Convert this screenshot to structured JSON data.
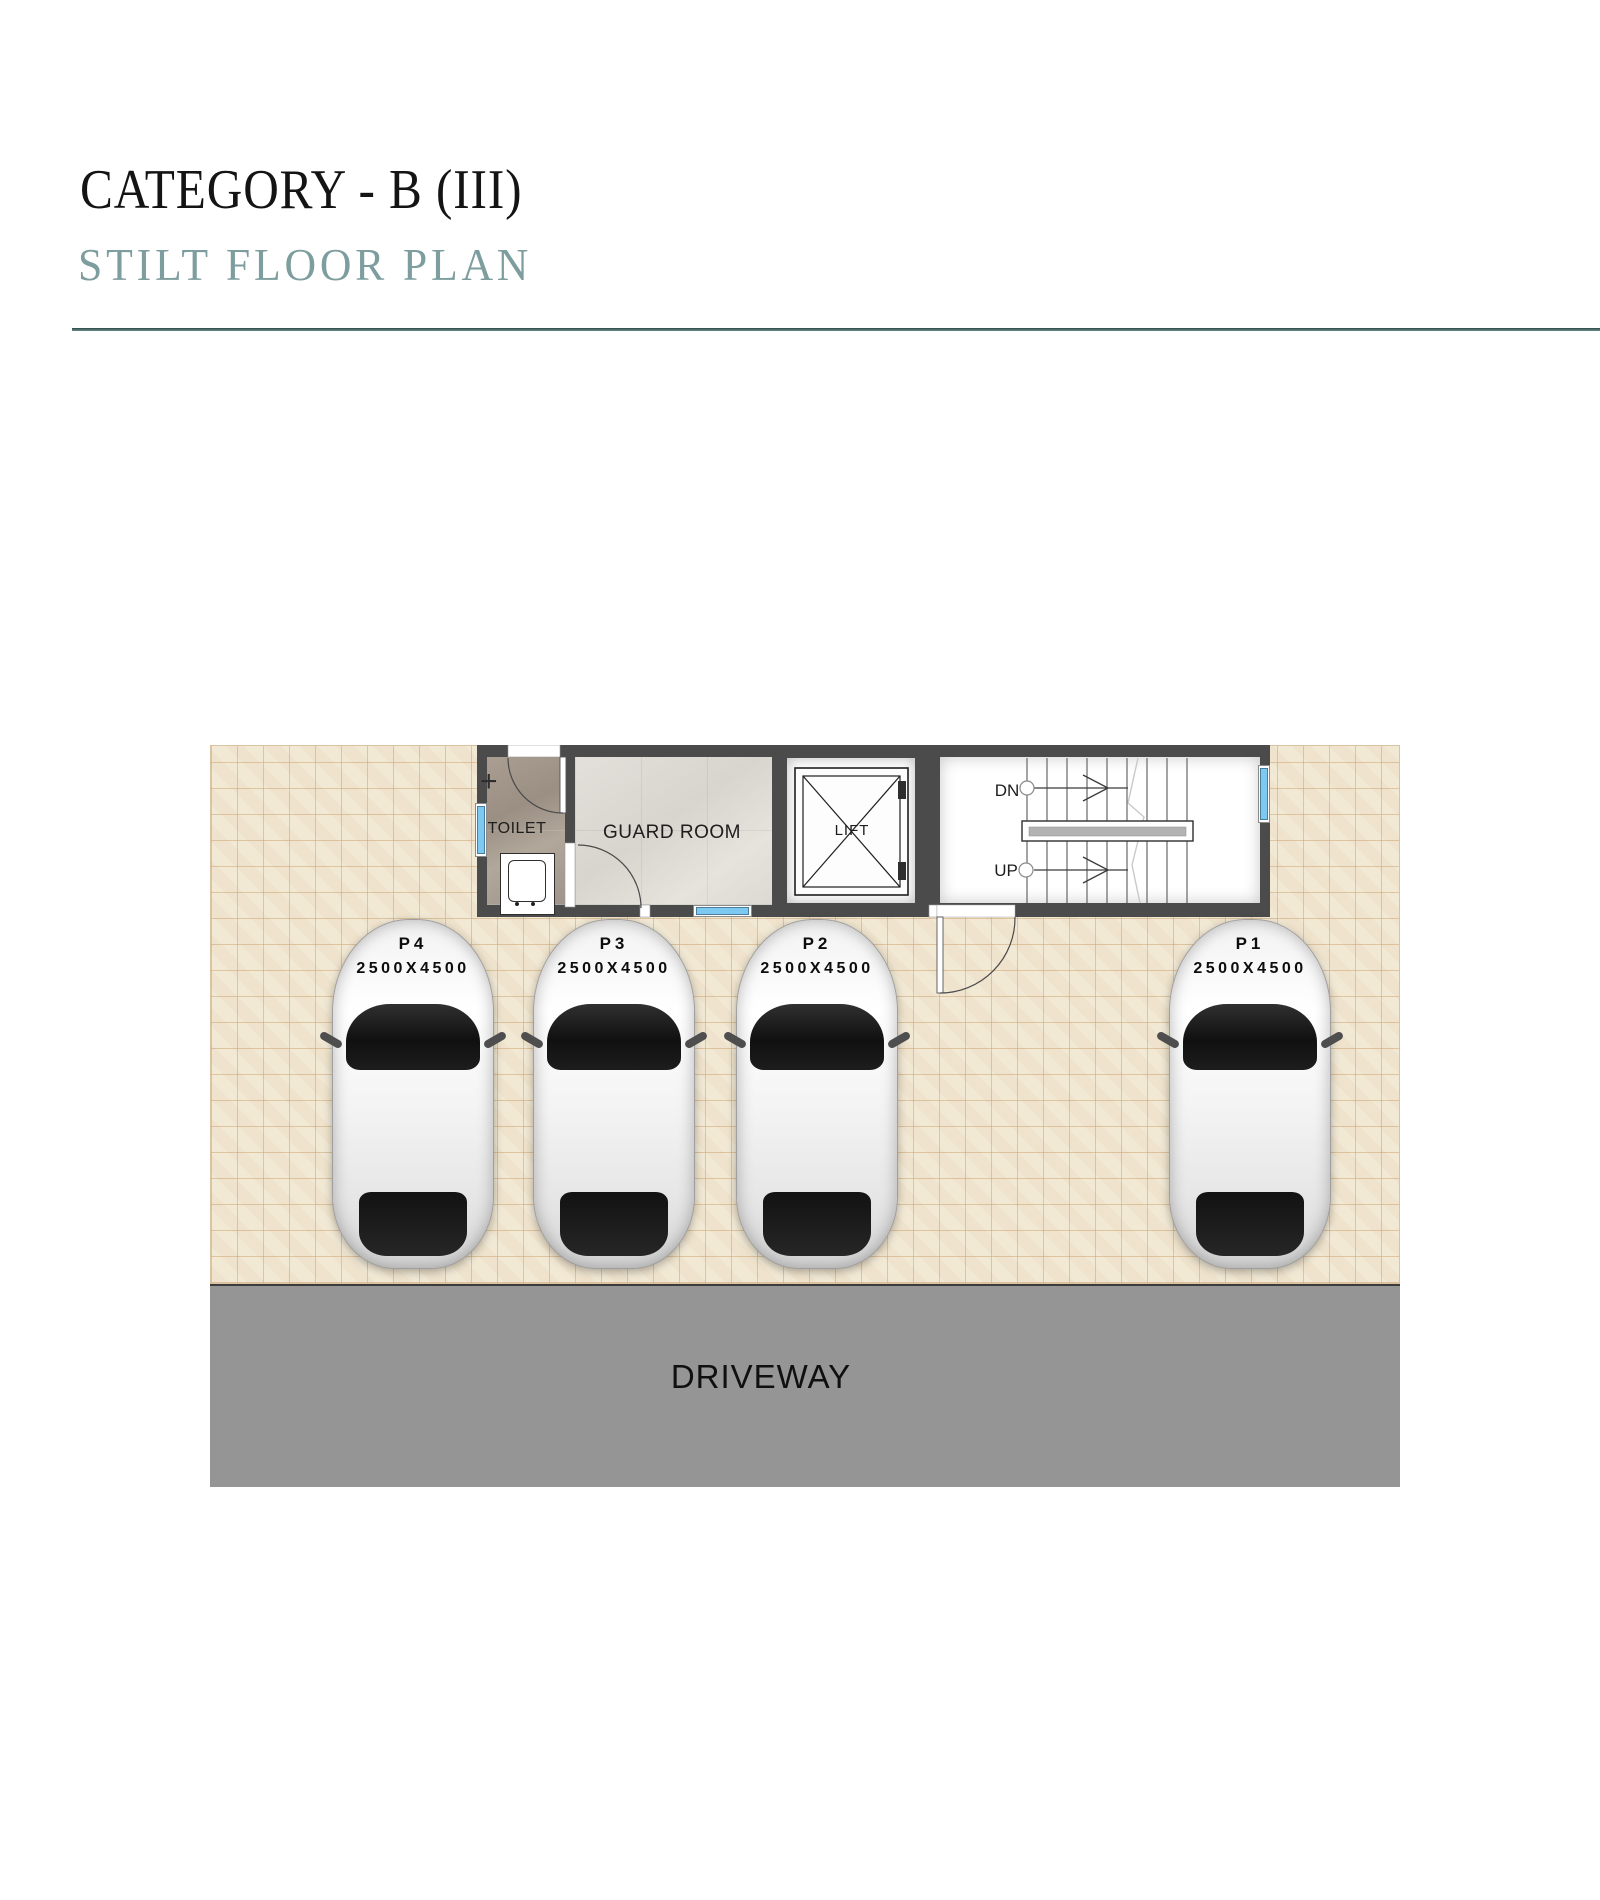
{
  "header": {
    "category_title": "CATEGORY - B (III)",
    "plan_title": "STILT FLOOR PLAN"
  },
  "plan": {
    "toilet_label": "TOILET",
    "guard_room_label": "GUARD ROOM",
    "lift_label": "LIFT",
    "stairs": {
      "down_label": "DN",
      "up_label": "UP"
    },
    "door_plus_marker": "+",
    "parking_spots": [
      {
        "id": "P4",
        "size": "2500X4500"
      },
      {
        "id": "P3",
        "size": "2500X4500"
      },
      {
        "id": "P2",
        "size": "2500X4500"
      },
      {
        "id": "P1",
        "size": "2500X4500"
      }
    ],
    "driveway_label": "DRIVEWAY"
  },
  "colors": {
    "title_text": "#141414",
    "accent_teal": "#7e9d9e",
    "rule_teal": "#2e4a47",
    "wall_gray": "#4b4b4b",
    "tile_beige": "#f2e9d5",
    "tile_grout": "#d9bf9f",
    "driveway_gray": "#959595",
    "window_blue": "#7ec9f1"
  }
}
